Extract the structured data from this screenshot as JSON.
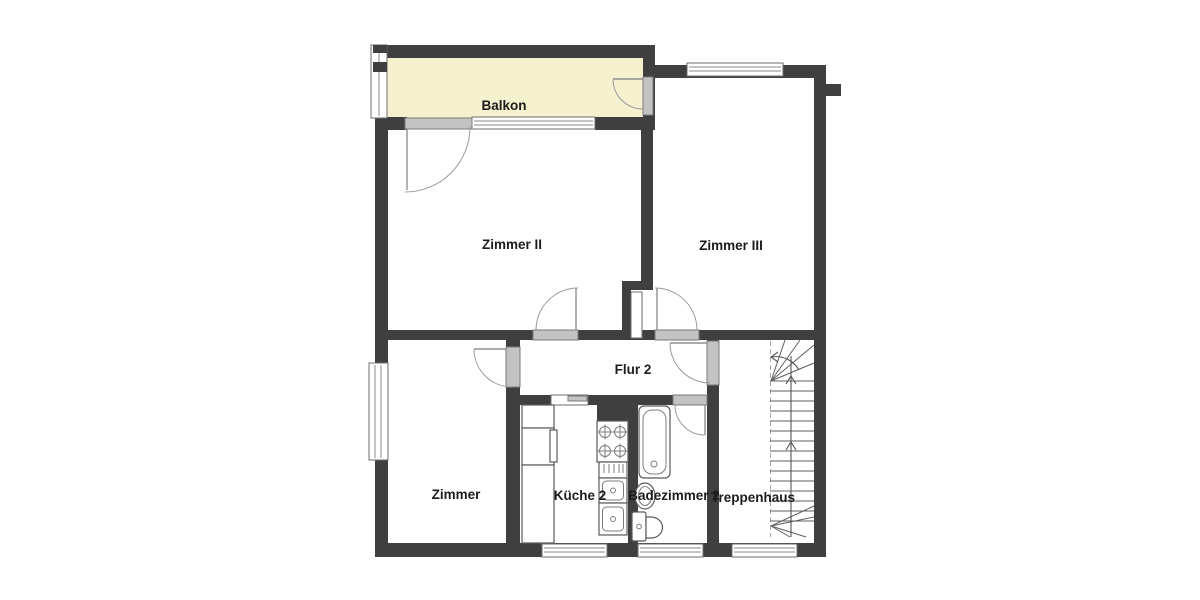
{
  "rooms": {
    "balkon": "Balkon",
    "zimmer_ii": "Zimmer II",
    "zimmer_iii": "Zimmer III",
    "flur_2": "Flur 2",
    "zimmer": "Zimmer",
    "kueche_2": "Küche 2",
    "badezimmer_2": "Badezimmer 2",
    "treppenhaus": "Treppenhaus"
  },
  "colors": {
    "wall": "#3f3f3f",
    "balcony_fill": "#f5f0cd",
    "door_fill": "#c3c3c3",
    "door_stroke": "#7a7a7a",
    "label_color": "#1c1c1c"
  }
}
